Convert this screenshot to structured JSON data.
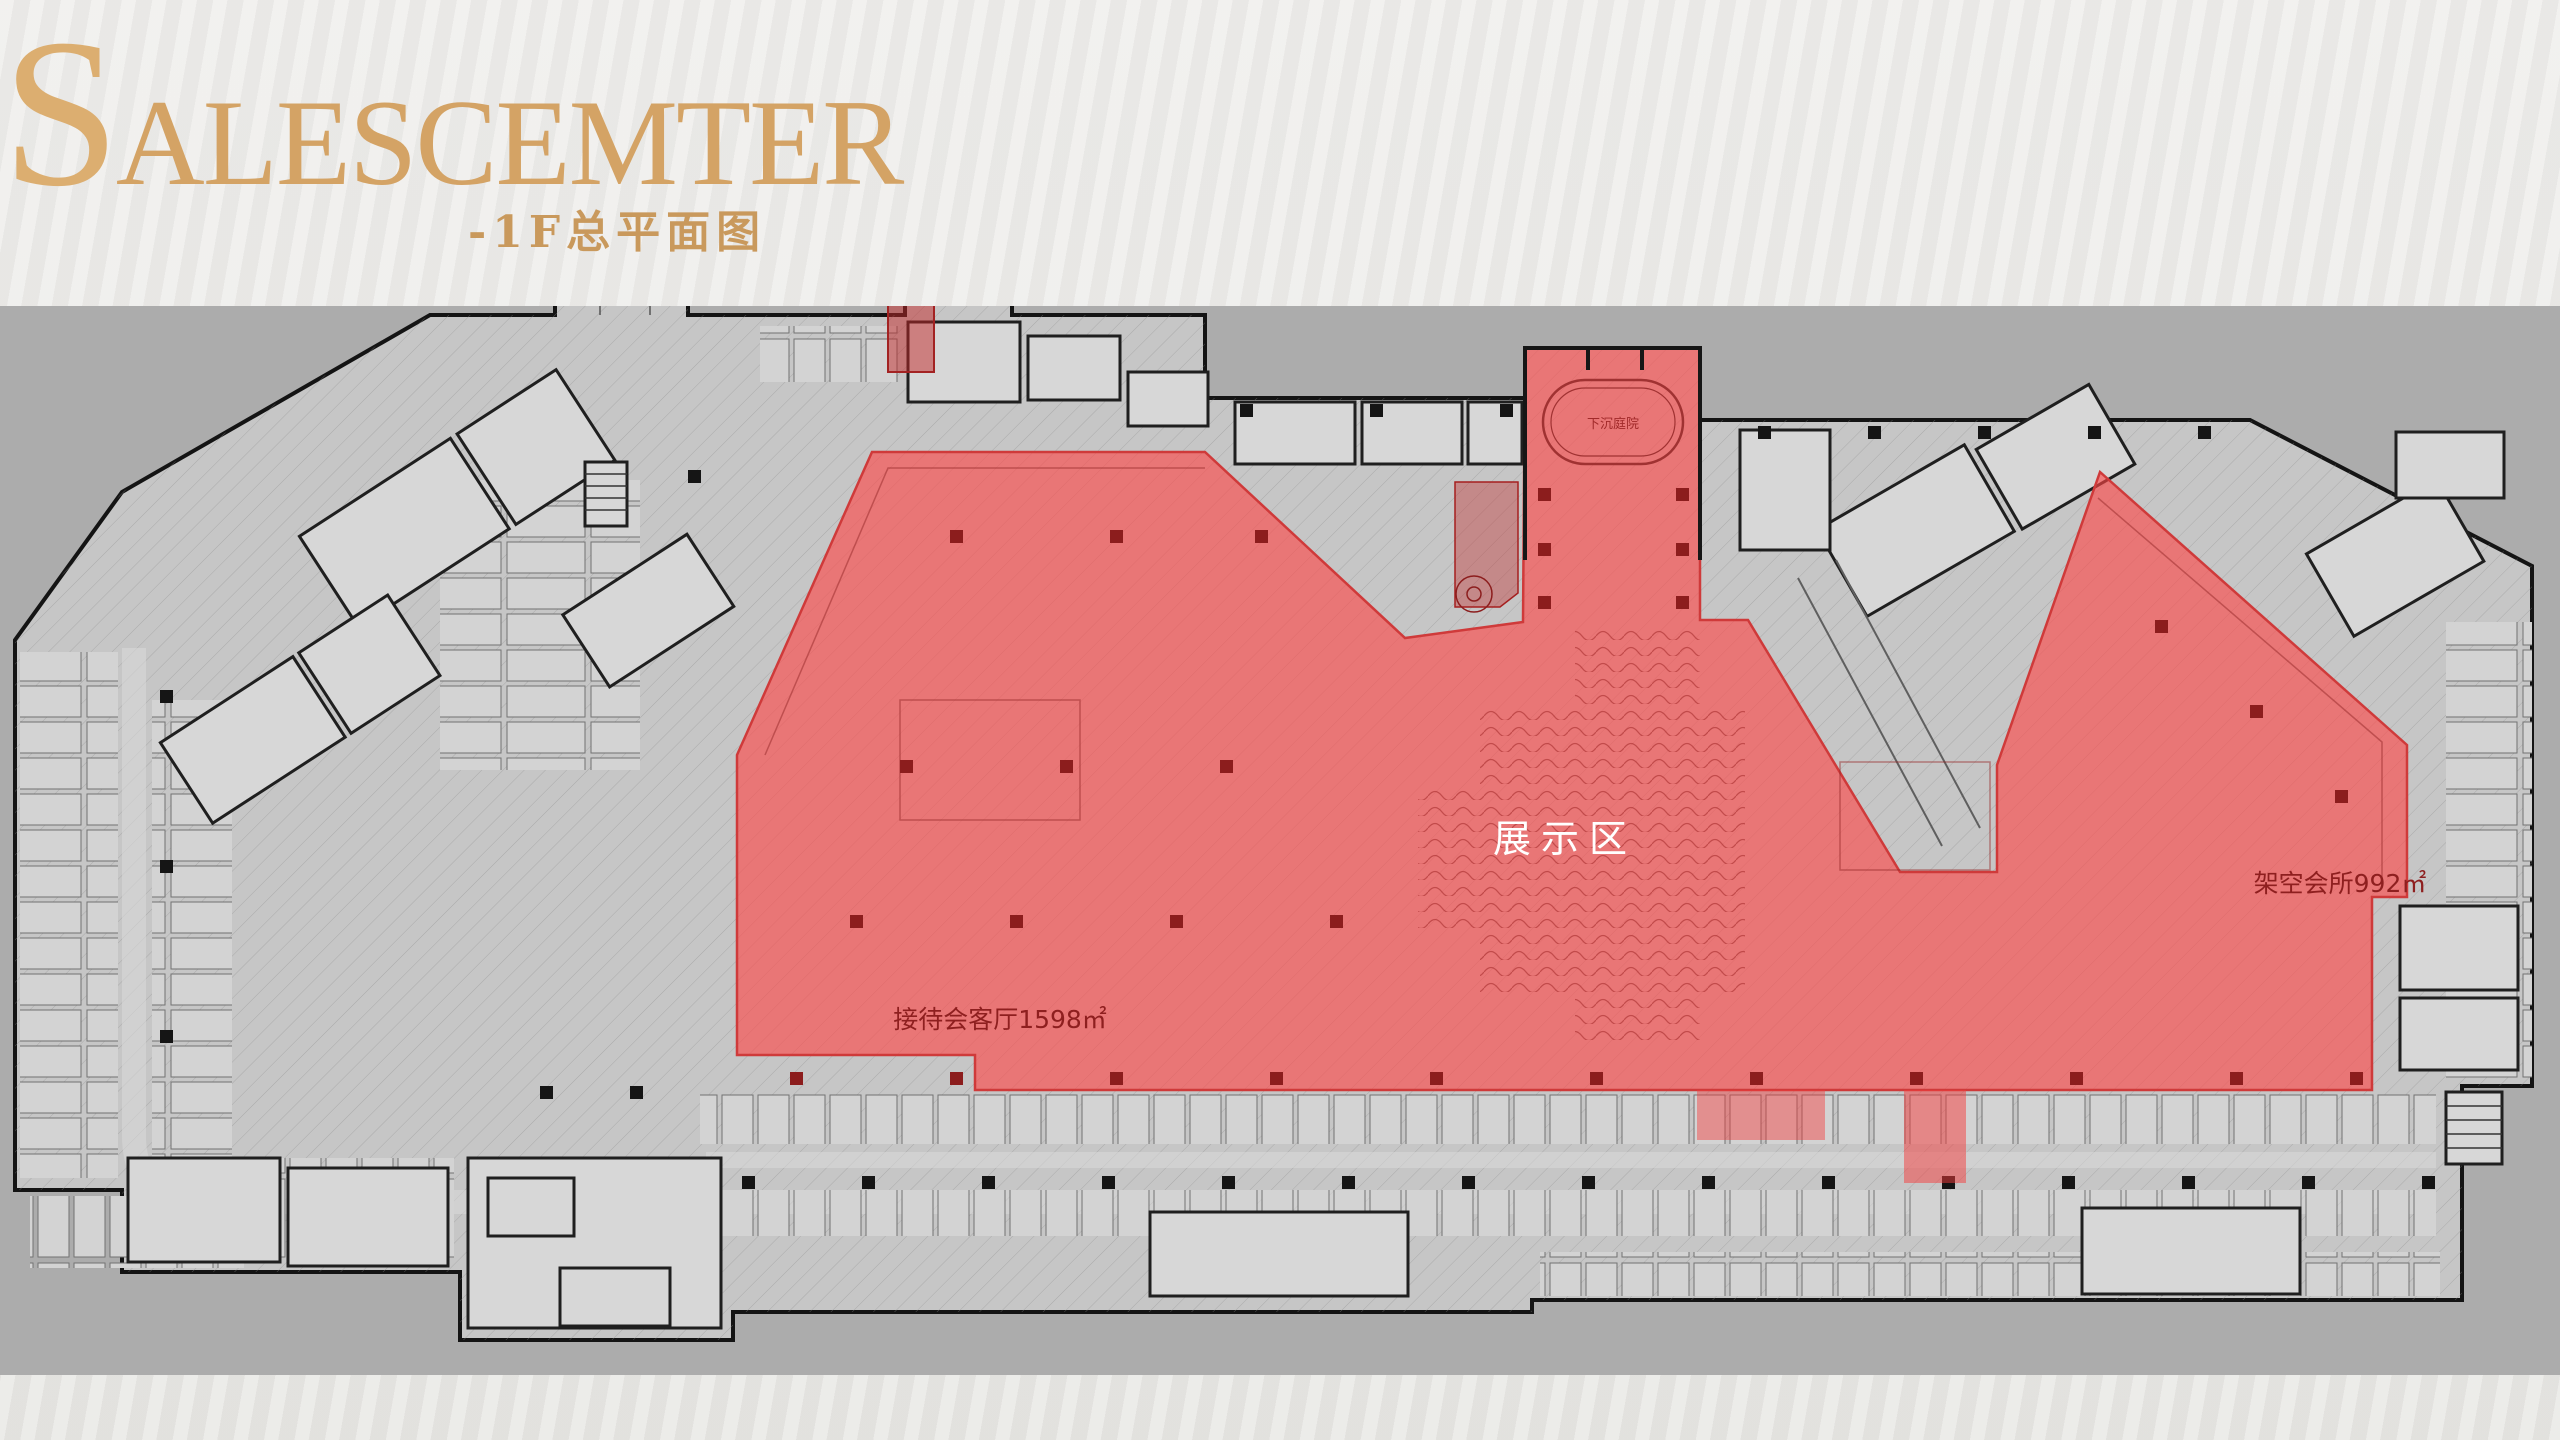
{
  "header": {
    "title_initial": "S",
    "title_rest": "ALESCEMTER",
    "subtitle": "-1F总平面图"
  },
  "plan": {
    "area_labels": {
      "display_area": "展示区",
      "reception_hall": "接待会客厅1598㎡",
      "elevated_clubhouse": "架空会所992㎡",
      "sunken_courtyard": "下沉庭院"
    },
    "colors": {
      "highlight_red": "#ff4646",
      "annotation_red": "#8e1f1f",
      "title_gold": "#d4a365",
      "band_gray": "#acacac"
    }
  }
}
